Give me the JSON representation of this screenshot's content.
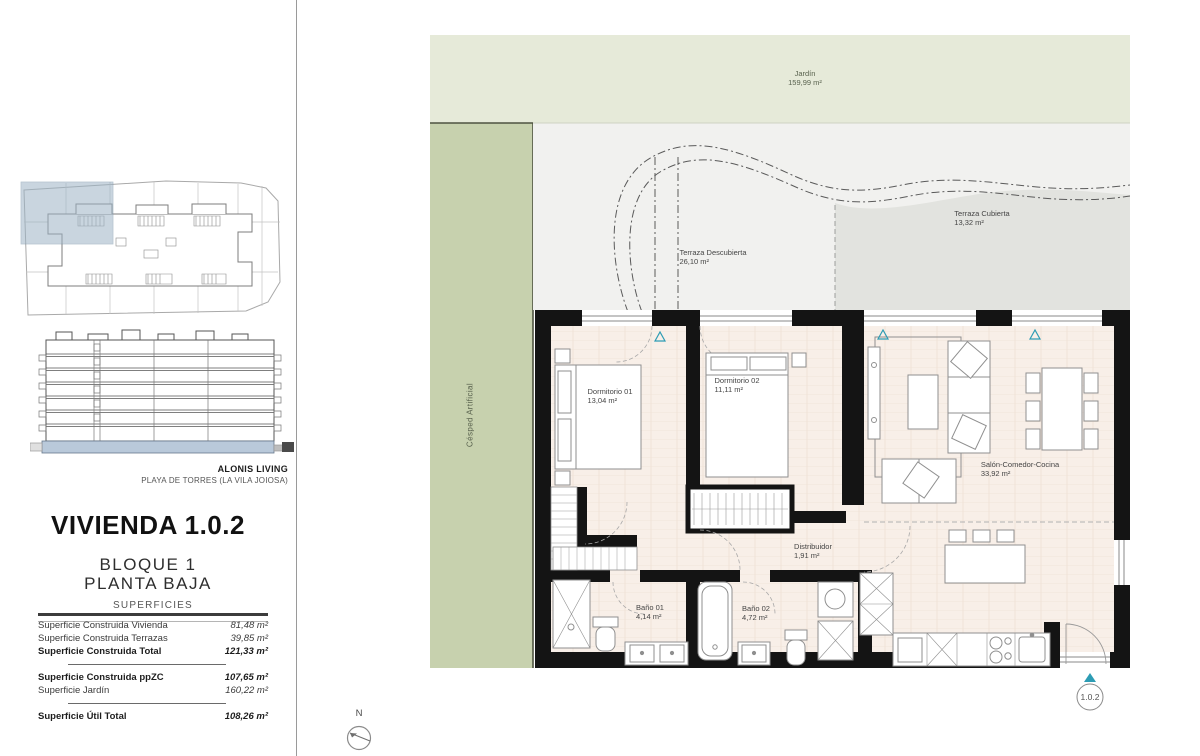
{
  "branding": {
    "project": "ALONIS LIVING",
    "location": "PLAYA DE TORRES (LA VILA JOIOSA)"
  },
  "unit": {
    "title": "VIVIENDA 1.0.2",
    "block": "BLOQUE 1",
    "floor": "PLANTA BAJA",
    "badge": "1.0.2"
  },
  "surfaces": {
    "heading": "SUPERFICIES",
    "rows": [
      {
        "label": "Superficie Construida Vivienda",
        "value": "81,48 m²"
      },
      {
        "label": "Superficie Construida Terrazas",
        "value": "39,85 m²"
      },
      {
        "label": "Superficie Construida Total",
        "value": "121,33 m²"
      },
      {
        "label": "Superficie Construida ppZC",
        "value": "107,65 m²"
      },
      {
        "label": "Superficie Jardín",
        "value": "160,22 m²"
      },
      {
        "label": "Superficie Útil Total",
        "value": "108,26 m²"
      }
    ]
  },
  "plan": {
    "compass": "N",
    "rooms": {
      "jardin": {
        "name": "Jardín",
        "area": "159,99 m²"
      },
      "cesped": {
        "name": "Césped Artificial",
        "area": ""
      },
      "terraza_descubierta": {
        "name": "Terraza Descubierta",
        "area": "26,10 m²"
      },
      "terraza_cubierta": {
        "name": "Terraza Cubierta",
        "area": "13,32 m²"
      },
      "dormitorio1": {
        "name": "Dormitorio 01",
        "area": "13,04 m²"
      },
      "dormitorio2": {
        "name": "Dormitorio 02",
        "area": "11,11 m²"
      },
      "salon": {
        "name": "Salón-Comedor-Cocina",
        "area": "33,92 m²"
      },
      "distribuidor": {
        "name": "Distribuidor",
        "area": "1,91 m²"
      },
      "bano1": {
        "name": "Baño 01",
        "area": "4,14 m²"
      },
      "bano2": {
        "name": "Baño 02",
        "area": "4,72 m²"
      }
    }
  },
  "colors": {
    "garden": "#e6ead9",
    "lawn": "#c7d1ae",
    "terrace": "#f1f1ef",
    "terrace_covered": "#e2e3df",
    "floor": "#f8efe8",
    "wall": "#141414",
    "marker_teal": "#2d9cb4",
    "highlight_blue": "#a9bfd0",
    "furniture_stroke": "#8f8f8f"
  }
}
